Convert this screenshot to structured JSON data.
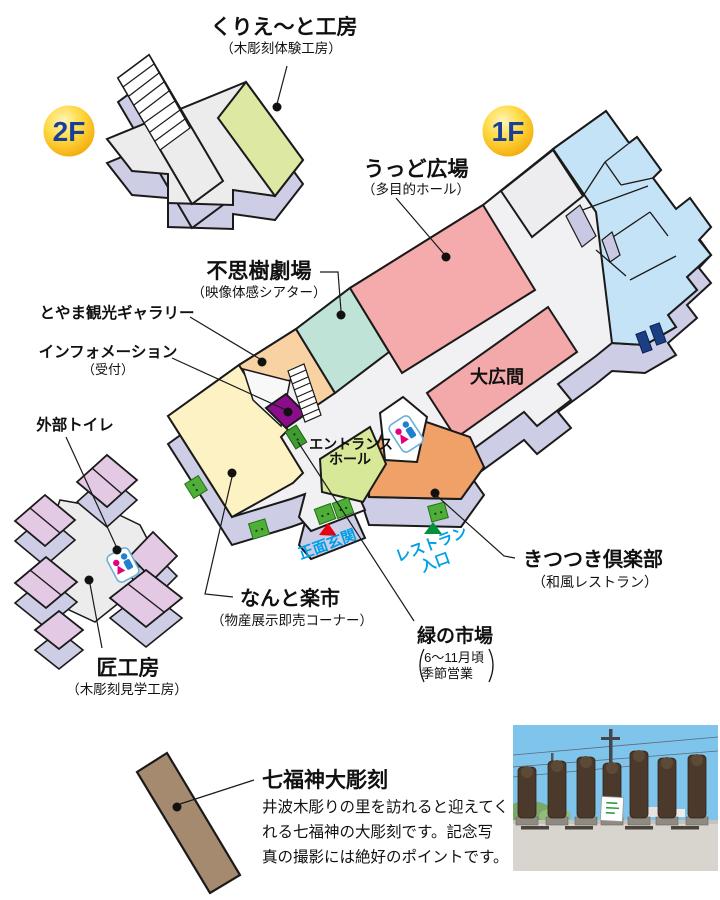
{
  "badges": {
    "f2": "2F",
    "f1": "1F"
  },
  "rooms_2f": {
    "create_studio": {
      "label": "くりえ〜と工房",
      "sublabel": "（木彫刻体験工房）"
    }
  },
  "rooms_1f": {
    "wood_plaza": {
      "label": "うっど広場",
      "sublabel": "（多目的ホール）"
    },
    "fushigi_theater": {
      "label": "不思樹劇場",
      "sublabel": "（映像体感シアター）"
    },
    "toyama_gallery": {
      "label": "とやま観光ギャラリー"
    },
    "information": {
      "label": "インフォメーション",
      "sublabel": "（受付）"
    },
    "entrance_hall": {
      "label_line1": "エントランス",
      "label_line2": "ホール"
    },
    "ohiroma": {
      "label": "大広間"
    },
    "kitsutsuki_club": {
      "label": "きつつき倶楽部",
      "sublabel": "（和風レストラン）"
    },
    "nanto_rakuichi": {
      "label": "なんと楽市",
      "sublabel": "（物産展示即売コーナー）"
    },
    "midori_market": {
      "label": "緑の市場",
      "season_line1": "6〜11月頃",
      "season_line2": "季節営業"
    }
  },
  "entrances": {
    "main": "正面玄関",
    "restaurant_line1": "レストラン",
    "restaurant_line2": "入口"
  },
  "outside": {
    "outdoor_toilet": {
      "label": "外部トイレ"
    },
    "takumi_studio": {
      "label": "匠工房",
      "sublabel": "（木彫刻見学工房）"
    },
    "shichifukujin": {
      "label": "七福神大彫刻",
      "desc_line1": "井波木彫りの里を訪れると迎えてく",
      "desc_line2": "れる七福神の大彫刻です。記念写",
      "desc_line3": "真の撮影には絶好のポイントです。"
    }
  },
  "colors": {
    "floor": "#f1f1f3",
    "wall": "#cdcde6",
    "outline": "#1a1a1a",
    "wood_plaza": "#f5abab",
    "ohiroma": "#f3a9a9",
    "theater": "#bfe3d6",
    "gallery": "#f9d2a4",
    "rakuichi": "#fcf2c4",
    "entrance_hall": "#d7e898",
    "restaurant": "#efa168",
    "info": "#8c0d8c",
    "blue_rooms": "#c5e3f6",
    "craft_room_2f": "#dde8a3",
    "takumi_pink": "#e3c9e3",
    "monument_brown": "#a58a6f",
    "door_green": "#4fae38",
    "window_navy": "#1c3e82",
    "badge_text": "#1a3f96",
    "cyan_label": "#00a0e9",
    "triangle_red": "#e60012",
    "triangle_green": "#00913a"
  }
}
